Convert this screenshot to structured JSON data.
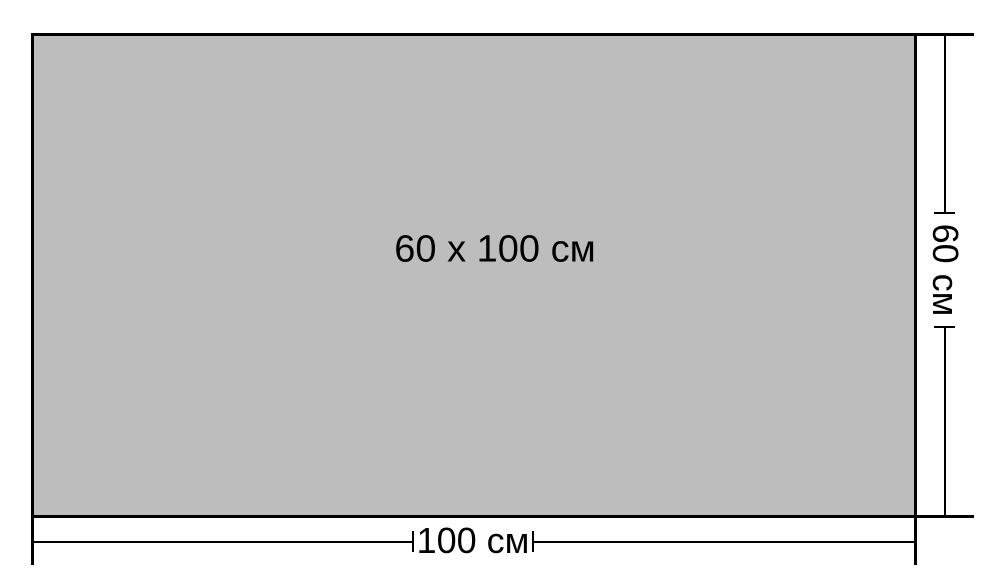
{
  "diagram": {
    "panel_label": "60 x 100 см",
    "width_label": "100 см",
    "height_label": "60 см",
    "colors": {
      "background": "#ffffff",
      "fill": "#bdbdbd",
      "line": "#000000"
    }
  }
}
